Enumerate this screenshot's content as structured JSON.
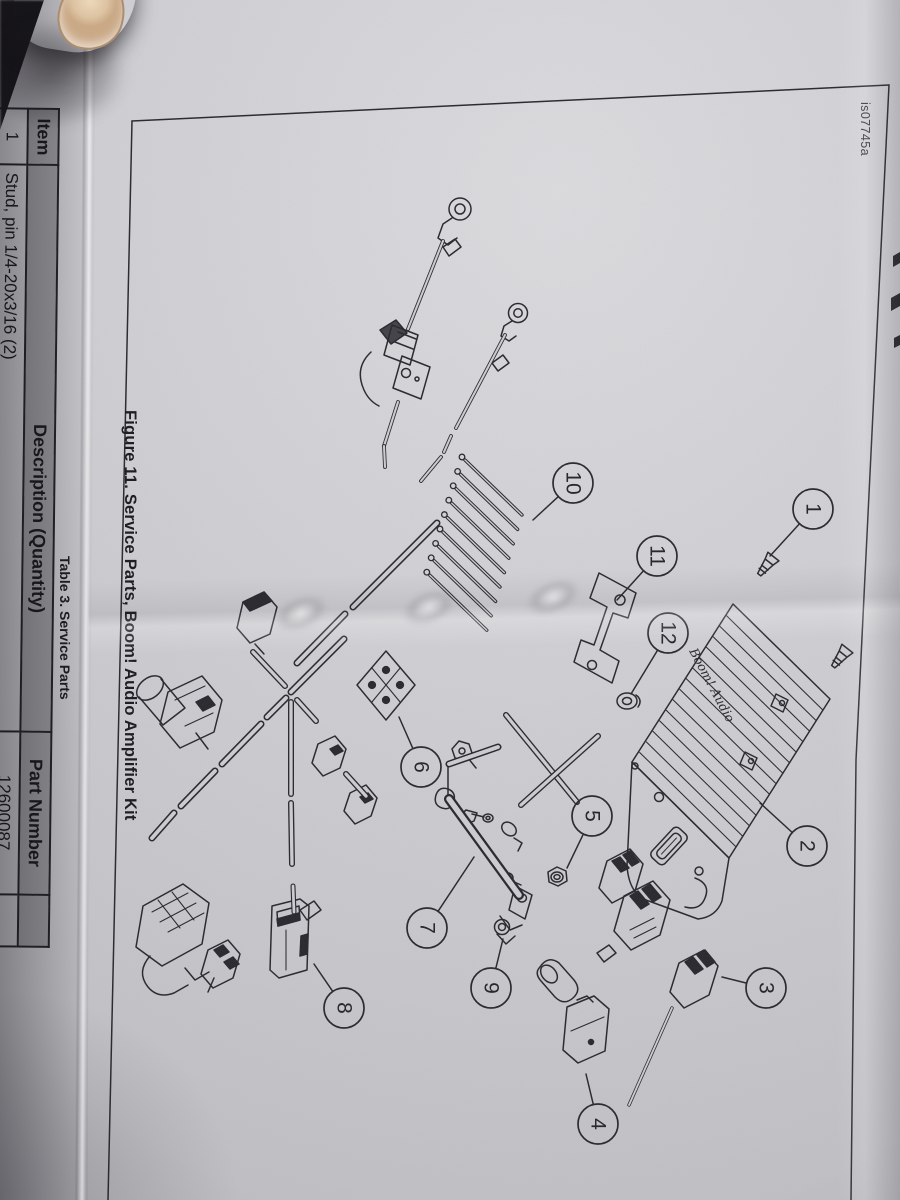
{
  "page": {
    "figure_id": "is07745a",
    "figure_caption": "Figure 11. Service Parts, Boom! Audio Amplifier Kit",
    "table_caption": "Table 3. Service Parts",
    "amplifier_logo": "Boom! Audio",
    "table": {
      "headers": [
        "Item",
        "Description (Quantity)",
        "Part Number"
      ],
      "rows": [
        {
          "item": "1",
          "description": "Stud, pin 1/4-20x3/16 (2)",
          "part_number": "12600087"
        },
        {
          "item": "2",
          "description": "",
          "part_number": ""
        }
      ]
    },
    "callouts": [
      {
        "n": "1",
        "cx": 813,
        "cy": 509,
        "tx": 770,
        "ty": 556
      },
      {
        "n": "2",
        "cx": 807,
        "cy": 846,
        "tx": 760,
        "ty": 803
      },
      {
        "n": "3",
        "cx": 766,
        "cy": 988,
        "tx": 722,
        "ty": 977
      },
      {
        "n": "4",
        "cx": 598,
        "cy": 1124,
        "tx": 586,
        "ty": 1074
      },
      {
        "n": "5",
        "cx": 592,
        "cy": 816,
        "tx": 567,
        "ty": 868
      },
      {
        "n": "6",
        "cx": 421,
        "cy": 767,
        "tx": 399,
        "ty": 717
      },
      {
        "n": "7",
        "cx": 427,
        "cy": 928,
        "tx": 474,
        "ty": 857
      },
      {
        "n": "8",
        "cx": 344,
        "cy": 1008,
        "tx": 314,
        "ty": 964
      },
      {
        "n": "9",
        "cx": 491,
        "cy": 988,
        "tx": 503,
        "ty": 939
      },
      {
        "n": "10",
        "cx": 573,
        "cy": 483,
        "tx": 533,
        "ty": 520
      },
      {
        "n": "11",
        "cx": 657,
        "cy": 556,
        "tx": 617,
        "ty": 600
      },
      {
        "n": "12",
        "cx": 668,
        "cy": 633,
        "tx": 631,
        "ty": 694
      }
    ],
    "colors": {
      "ink": "#26262c",
      "paper": "#cfcfd3",
      "table_header": "#97979b"
    }
  }
}
